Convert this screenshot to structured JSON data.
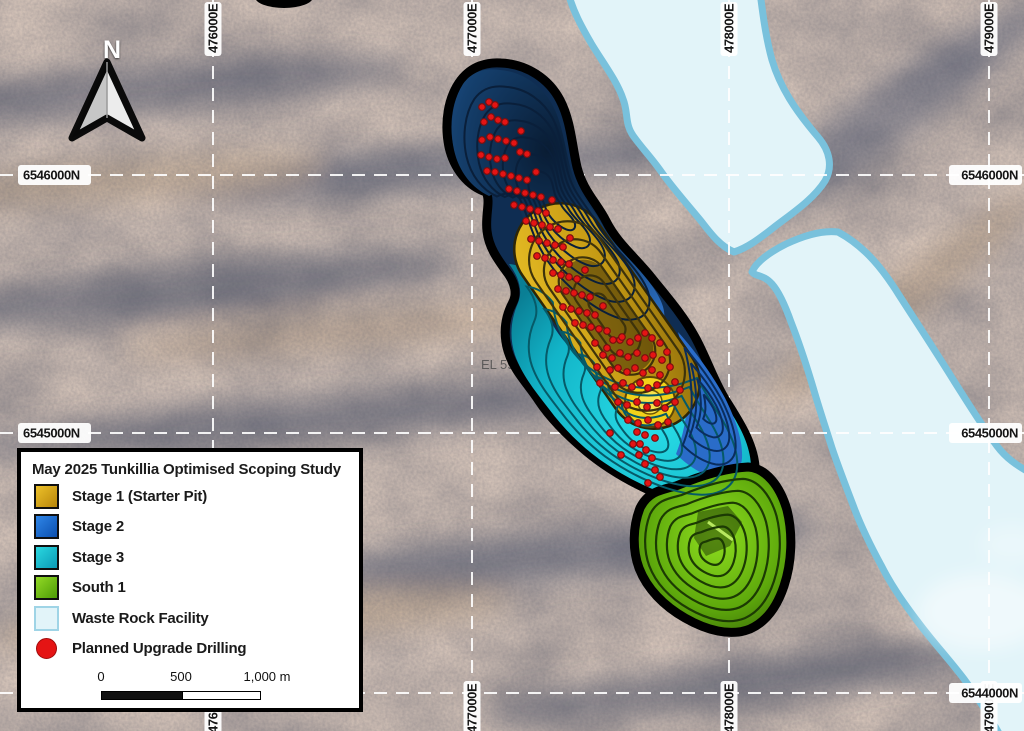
{
  "map": {
    "el_label": "EL 590",
    "north_indicator": "N",
    "gridline_color": "#ffffff",
    "grid": {
      "eastings": [
        {
          "label": "476000E",
          "x": 213,
          "top": true,
          "bottom": true
        },
        {
          "label": "477000E",
          "x": 472,
          "top": true,
          "bottom": true
        },
        {
          "label": "478000E",
          "x": 729,
          "top": true,
          "bottom": true
        },
        {
          "label": "479000E",
          "x": 989,
          "top": true,
          "bottom": true
        }
      ],
      "northings": [
        {
          "label": "6546000N",
          "y": 175,
          "left": true,
          "right": true
        },
        {
          "label": "6545000N",
          "y": 433,
          "left": true,
          "right": true
        },
        {
          "label": "6544000N",
          "y": 693,
          "left": false,
          "right": true
        }
      ]
    }
  },
  "legend": {
    "title": "May 2025 Tunkillia Optimised Scoping Study",
    "items": [
      {
        "label": "Stage 1 (Starter Pit)",
        "type": "swatch",
        "color1": "#edc12a",
        "color2": "#b8860b",
        "border": "#101010"
      },
      {
        "label": "Stage 2",
        "type": "swatch",
        "color1": "#2f86e8",
        "color2": "#0c4fae",
        "border": "#101010"
      },
      {
        "label": "Stage 3",
        "type": "swatch",
        "color1": "#2ad8e0",
        "color2": "#0b9ab6",
        "border": "#101010"
      },
      {
        "label": "South 1",
        "type": "swatch",
        "color1": "#93da26",
        "color2": "#4d9c06",
        "border": "#101010"
      },
      {
        "label": "Waste Rock Facility",
        "type": "swatch",
        "color1": "#e2f4f9",
        "color2": "#e2f4f9",
        "border": "#9fd4e6"
      },
      {
        "label": "Planned Upgrade Drilling",
        "type": "dot",
        "color1": "#e51414",
        "color2": "#e51414",
        "border": "#a00b0b"
      }
    ],
    "scalebar": {
      "ticks": [
        "0",
        "500",
        "1,000 m"
      ]
    }
  },
  "drill_holes": {
    "symbol": "red-dot",
    "color": "#e51414",
    "points": [
      [
        482,
        107
      ],
      [
        489,
        102
      ],
      [
        495,
        105
      ],
      [
        484,
        122
      ],
      [
        491,
        117
      ],
      [
        498,
        120
      ],
      [
        505,
        122
      ],
      [
        482,
        140
      ],
      [
        490,
        137
      ],
      [
        498,
        139
      ],
      [
        506,
        141
      ],
      [
        514,
        143
      ],
      [
        521,
        131
      ],
      [
        481,
        155
      ],
      [
        489,
        157
      ],
      [
        497,
        159
      ],
      [
        505,
        158
      ],
      [
        520,
        152
      ],
      [
        527,
        154
      ],
      [
        487,
        171
      ],
      [
        495,
        172
      ],
      [
        503,
        174
      ],
      [
        511,
        176
      ],
      [
        519,
        178
      ],
      [
        527,
        180
      ],
      [
        536,
        172
      ],
      [
        509,
        189
      ],
      [
        517,
        191
      ],
      [
        525,
        193
      ],
      [
        533,
        195
      ],
      [
        541,
        197
      ],
      [
        552,
        200
      ],
      [
        514,
        205
      ],
      [
        522,
        207
      ],
      [
        530,
        209
      ],
      [
        538,
        211
      ],
      [
        546,
        213
      ],
      [
        526,
        221
      ],
      [
        534,
        223
      ],
      [
        542,
        225
      ],
      [
        550,
        227
      ],
      [
        558,
        229
      ],
      [
        570,
        238
      ],
      [
        531,
        239
      ],
      [
        539,
        241
      ],
      [
        547,
        243
      ],
      [
        555,
        245
      ],
      [
        563,
        247
      ],
      [
        537,
        256
      ],
      [
        545,
        258
      ],
      [
        553,
        260
      ],
      [
        561,
        262
      ],
      [
        569,
        264
      ],
      [
        585,
        270
      ],
      [
        553,
        273
      ],
      [
        561,
        275
      ],
      [
        569,
        277
      ],
      [
        577,
        279
      ],
      [
        558,
        289
      ],
      [
        566,
        291
      ],
      [
        574,
        293
      ],
      [
        582,
        295
      ],
      [
        590,
        297
      ],
      [
        603,
        306
      ],
      [
        563,
        307
      ],
      [
        571,
        309
      ],
      [
        579,
        311
      ],
      [
        587,
        313
      ],
      [
        595,
        315
      ],
      [
        575,
        323
      ],
      [
        583,
        325
      ],
      [
        591,
        327
      ],
      [
        599,
        329
      ],
      [
        607,
        331
      ],
      [
        620,
        340
      ],
      [
        595,
        343
      ],
      [
        607,
        348
      ],
      [
        613,
        340
      ],
      [
        622,
        337
      ],
      [
        630,
        342
      ],
      [
        638,
        338
      ],
      [
        645,
        333
      ],
      [
        652,
        338
      ],
      [
        660,
        343
      ],
      [
        603,
        355
      ],
      [
        612,
        358
      ],
      [
        620,
        353
      ],
      [
        628,
        357
      ],
      [
        637,
        353
      ],
      [
        645,
        358
      ],
      [
        653,
        355
      ],
      [
        662,
        360
      ],
      [
        667,
        352
      ],
      [
        597,
        367
      ],
      [
        610,
        370
      ],
      [
        618,
        368
      ],
      [
        627,
        372
      ],
      [
        635,
        368
      ],
      [
        643,
        373
      ],
      [
        652,
        370
      ],
      [
        660,
        375
      ],
      [
        670,
        367
      ],
      [
        600,
        383
      ],
      [
        615,
        387
      ],
      [
        623,
        383
      ],
      [
        632,
        387
      ],
      [
        640,
        383
      ],
      [
        648,
        388
      ],
      [
        657,
        385
      ],
      [
        667,
        390
      ],
      [
        675,
        382
      ],
      [
        680,
        390
      ],
      [
        618,
        402
      ],
      [
        627,
        405
      ],
      [
        637,
        402
      ],
      [
        647,
        407
      ],
      [
        657,
        403
      ],
      [
        665,
        408
      ],
      [
        675,
        402
      ],
      [
        628,
        420
      ],
      [
        638,
        423
      ],
      [
        648,
        420
      ],
      [
        658,
        425
      ],
      [
        668,
        422
      ],
      [
        637,
        432
      ],
      [
        645,
        435
      ],
      [
        655,
        438
      ],
      [
        610,
        433
      ],
      [
        640,
        444
      ],
      [
        646,
        450
      ],
      [
        639,
        455
      ],
      [
        652,
        458
      ],
      [
        645,
        464
      ],
      [
        655,
        470
      ],
      [
        633,
        444
      ],
      [
        621,
        455
      ],
      [
        660,
        477
      ],
      [
        648,
        483
      ]
    ]
  },
  "colors": {
    "stage1_gold": "#d9a81c",
    "stage2_blue": "#1d5cb4",
    "stage3_cyan": "#14bfd2",
    "south1_green": "#5ea90c",
    "waste_rock_fill": "#e2f4f9",
    "waste_rock_border": "#79c1dc",
    "pit_outline": "#000000",
    "drill_dot": "#e51414"
  }
}
